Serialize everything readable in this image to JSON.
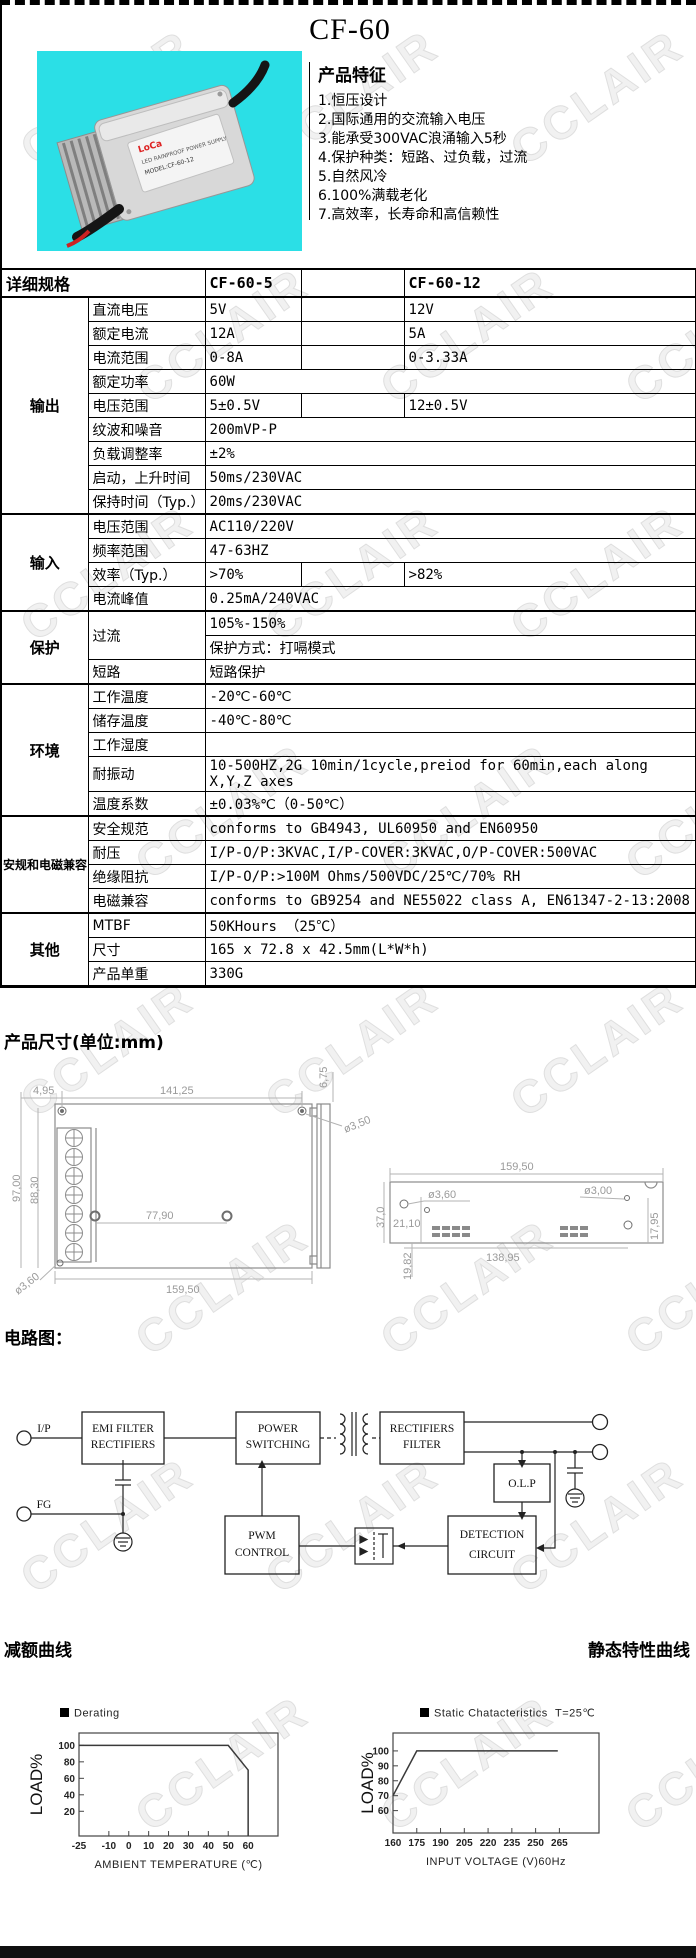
{
  "watermark": "CCLAIR",
  "header": {
    "title": "CF-60",
    "features_heading": "产品特征",
    "features": [
      "1.恒压设计",
      "2.国际通用的交流输入电压",
      "3.能承受300VAC浪涌输入5秒",
      "4.保护种类：短路、过负载，过流",
      "5.自然风冷",
      "6.100%满载老化",
      "7.高效率，长寿命和高信赖性"
    ],
    "photo_label": {
      "brand": "LoCa",
      "line1": "LED RAINPROOF POWER SUPPLY",
      "line2": "MODEL:CF-60-12"
    }
  },
  "spec_table": {
    "header": {
      "col0": "详细规格",
      "col1": "CF-60-5",
      "col2": "",
      "col3": "CF-60-12"
    },
    "sections": [
      {
        "name": "输出",
        "rows": [
          {
            "label": "直流电压",
            "v1": "5V",
            "v2": "12V",
            "split": true
          },
          {
            "label": "额定电流",
            "v1": "12A",
            "v2": "5A",
            "split": true
          },
          {
            "label": "电流范围",
            "v1": "0-8A",
            "v2": "0-3.33A",
            "split": true
          },
          {
            "label": "额定功率",
            "span": "60W"
          },
          {
            "label": "电压范围",
            "v1": "5±0.5V",
            "v2": "12±0.5V",
            "split": true
          },
          {
            "label": "纹波和噪音",
            "span": "200mVP-P"
          },
          {
            "label": "负载调整率",
            "span": "±2%"
          },
          {
            "label": "启动，上升时间",
            "span": "50ms/230VAC"
          },
          {
            "label": "保持时间（Typ.）",
            "span": "20ms/230VAC"
          }
        ]
      },
      {
        "name": "输入",
        "rows": [
          {
            "label": "电压范围",
            "span": "AC110/220V"
          },
          {
            "label": "频率范围",
            "span": "47-63HZ"
          },
          {
            "label": "效率（Typ.）",
            "v1": ">70%",
            "v2": ">82%",
            "split": true
          },
          {
            "label": "电流峰值",
            "span": "0.25mA/240VAC"
          }
        ]
      },
      {
        "name": "保护",
        "rows": [
          {
            "label": "过流",
            "multi": [
              "105%-150%",
              "保护方式：打嗝模式"
            ]
          },
          {
            "label": "短路",
            "span": "短路保护"
          }
        ]
      },
      {
        "name": "环境",
        "rows": [
          {
            "label": "工作温度",
            "span": "-20℃-60℃"
          },
          {
            "label": "储存温度",
            "span": "-40℃-80℃"
          },
          {
            "label": "工作湿度",
            "span": ""
          },
          {
            "label": "耐振动",
            "span": "10-500HZ,2G 10min/1cycle,preiod for 60min,each along X,Y,Z axes"
          },
          {
            "label": "温度系数",
            "span": "±0.03%℃（0-50℃）"
          }
        ]
      },
      {
        "name": "安规和电磁兼容",
        "rows": [
          {
            "label": "安全规范",
            "span": "conforms to GB4943, UL60950 and EN60950"
          },
          {
            "label": "耐压",
            "span": "I/P-O/P:3KVAC,I/P-COVER:3KVAC,O/P-COVER:500VAC"
          },
          {
            "label": "绝缘阻抗",
            "span": "I/P-O/P:>100M Ohms/500VDC/25℃/70% RH"
          },
          {
            "label": "电磁兼容",
            "span": "conforms to GB9254 and NE55022 class A, EN61347-2-13:2008"
          }
        ]
      },
      {
        "name": "其他",
        "rows": [
          {
            "label": "MTBF",
            "span": "50KHours （25℃）"
          },
          {
            "label": "尺寸",
            "span": "165 x 72.8 x 42.5mm(L*W*h)"
          },
          {
            "label": "产品单重",
            "span": "330G"
          }
        ]
      }
    ]
  },
  "dimensions": {
    "heading": "产品尺寸(单位:mm)",
    "front": {
      "offset_left": "4,95",
      "hole_span": "141,25",
      "flange": "6,75",
      "hole_dia": "ø3,50",
      "height_outer": "97,00",
      "height_inner": "88,30",
      "mid_span": "77,90",
      "width": "159,50",
      "flange_hole_dia": "ø3,60"
    },
    "side": {
      "width": "159,50",
      "hole_dia_left": "ø3,60",
      "hole_dia_right": "ø3,00",
      "height": "37,0",
      "hole_offset": "21,10",
      "hole_span": "138,95",
      "right_offset": "17,95",
      "left_offset": "19,82"
    }
  },
  "circuit": {
    "heading": "电路图：",
    "terminal_ip": "I/P",
    "terminal_fg": "FG",
    "blocks": {
      "emi": [
        "EMI FILTER",
        "RECTIFIERS"
      ],
      "power": [
        "POWER",
        "SWITCHING"
      ],
      "rect": [
        "RECTIFIERS",
        "FILTER"
      ],
      "olp": [
        "O.L.P"
      ],
      "detection": [
        "DETECTION",
        "CIRCUIT"
      ],
      "pwm": [
        "PWM",
        "CONTROL"
      ]
    }
  },
  "chart_headings": {
    "left": "减额曲线",
    "right": "静态特性曲线"
  },
  "chart_data": [
    {
      "type": "line",
      "title": "减额曲线",
      "legend": "Derating",
      "legend_note": "",
      "xlabel": "AMBIENT TEMPERATURE (℃)",
      "ylabel": "LOAD%",
      "x_ticks": [
        -25,
        -10,
        0,
        10,
        20,
        30,
        40,
        50,
        60
      ],
      "y_ticks": [
        20,
        40,
        60,
        80,
        100
      ],
      "xlim": [
        -25,
        75
      ],
      "ylim": [
        -10,
        115
      ],
      "series": [
        {
          "name": "Derating",
          "points": [
            [
              -25,
              100
            ],
            [
              50,
              100
            ],
            [
              60,
              70
            ],
            [
              60,
              -10
            ]
          ]
        }
      ]
    },
    {
      "type": "line",
      "title": "静态特性曲线",
      "legend": "Static Chatacteristics",
      "legend_note": "T=25℃",
      "xlabel": "INPUT VOLTAGE (V)60Hz",
      "ylabel": "LOAD%",
      "x_ticks": [
        160,
        175,
        190,
        205,
        220,
        235,
        250,
        265
      ],
      "y_ticks": [
        60,
        70,
        80,
        90,
        100
      ],
      "xlim": [
        160,
        290
      ],
      "ylim": [
        45,
        112
      ],
      "series": [
        {
          "name": "Static Chatacteristics",
          "points": [
            [
              160,
              70
            ],
            [
              175,
              100
            ],
            [
              264,
              100
            ]
          ]
        }
      ]
    }
  ]
}
